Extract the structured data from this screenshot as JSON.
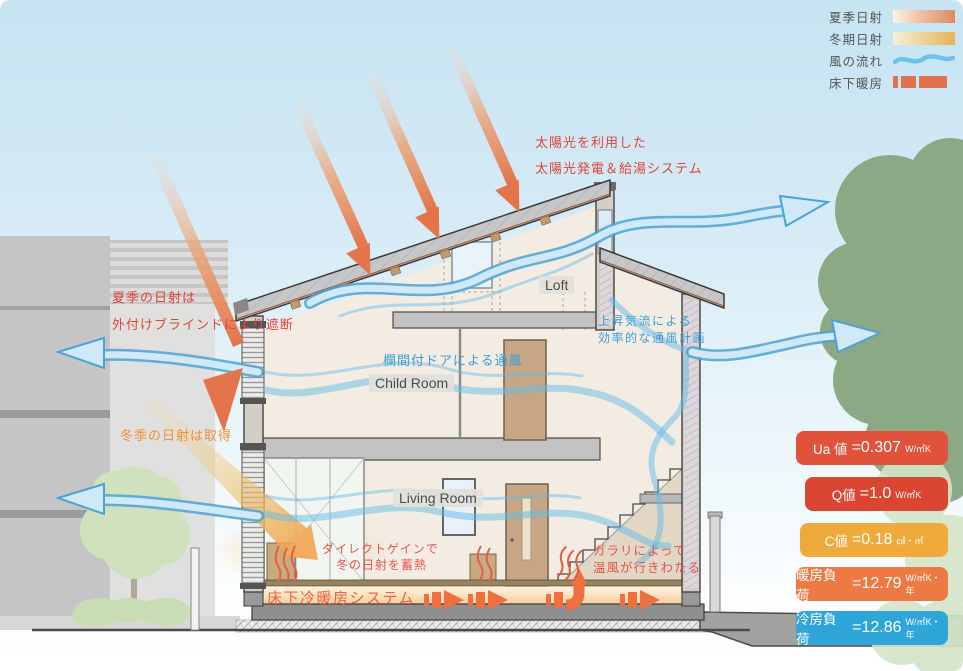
{
  "legend": {
    "items": [
      {
        "label": "夏季日射",
        "swatch": "summer-gradient"
      },
      {
        "label": "冬期日射",
        "swatch": "winter-gradient"
      },
      {
        "label": "風の流れ",
        "swatch": "wind-line"
      },
      {
        "label": "床下暖房",
        "swatch": "floor-heating-blocks"
      }
    ]
  },
  "annotations": {
    "solar_system": {
      "line1": "太陽光を利用した",
      "line2": "太陽光発電＆給湯システム",
      "color": "#e0453a"
    },
    "summer_shade": {
      "line1": "夏季の日射は",
      "line2": "外付けブラインドにより遮断",
      "color": "#e0453a"
    },
    "winter_gain": {
      "text": "冬季の日射は取得",
      "color": "#ef8f3a"
    },
    "transom_vent": {
      "text": "欄間付ドアによる通風",
      "color": "#3d9fd8"
    },
    "updraft": {
      "line1": "上昇気流による",
      "line2": "効率的な通風計画",
      "color": "#3d9fd8"
    },
    "direct_gain": {
      "line1": "ダイレクトゲインで",
      "line2": "冬の日射を蓄熱",
      "color": "#e4554c"
    },
    "louver": {
      "line1": "ガラリによって",
      "line2": "温風が行きわたる",
      "color": "#e4554c"
    },
    "underfloor_system": {
      "text": "床下冷暖房システム",
      "color": "#e8643c"
    }
  },
  "rooms": {
    "loft": "Loft",
    "child_room": "Child Room",
    "living_room": "Living Room"
  },
  "metrics": [
    {
      "label": "Ua 値",
      "value": "=0.307",
      "unit": "W/㎡K",
      "color": "#e1523b"
    },
    {
      "label": "Q値",
      "value": "=1.0",
      "unit": "W/㎡K",
      "color": "#da4631"
    },
    {
      "label": "C値",
      "value": "=0.18",
      "unit": "㎠・㎡",
      "color": "#eeab3c"
    },
    {
      "label": "暖房負荷",
      "value": "=12.79",
      "unit": "W/㎡K・年",
      "color": "#ec7a42"
    },
    {
      "label": "冷房負荷",
      "value": "=12.86",
      "unit": "W/㎡K・年",
      "color": "#2ea6d8"
    }
  ],
  "colors": {
    "sky_top": "#c6e4f2",
    "wind_flow": "#64bbe8",
    "summer_sun": "#e4744a",
    "winter_beam": "#f2a85a",
    "underfloor_arrow": "#ee7040",
    "tree_right": "#8ca986",
    "tree_left": "#cfe2bd",
    "legend_heat_block": "#e2724e"
  }
}
